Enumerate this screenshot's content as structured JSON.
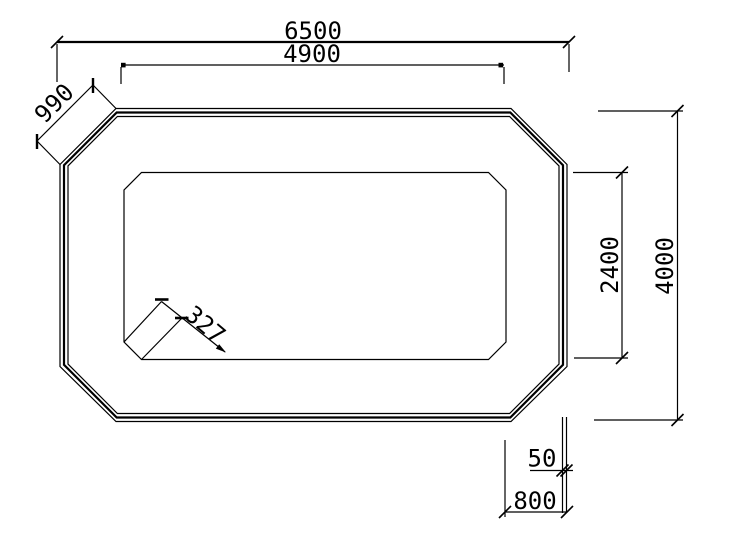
{
  "drawing": {
    "background_color": "#ffffff",
    "line_color": "#000000",
    "shape": "chamfered-rectangle-octagon-with-triple-border-and-inner-panel",
    "dimensions": {
      "overall_width": "6500",
      "inner_width": "4900",
      "corner_chamfer_diagonal": "990",
      "overall_height": "4000",
      "inner_height": "2400",
      "inner_corner_chamfer": "327",
      "border_band_gap": "50",
      "border_offset": "800"
    }
  }
}
